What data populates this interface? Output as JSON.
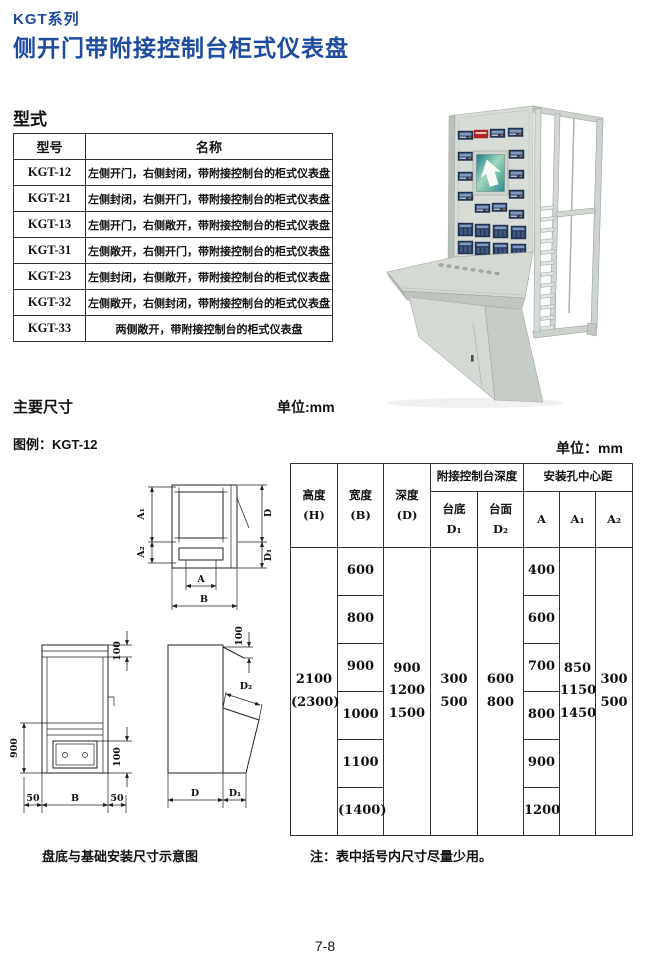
{
  "colors": {
    "title_blue": "#1c4ba0",
    "line_black": "#222222",
    "photo_panel_gray": "#d8dcd6",
    "photo_instrument_navy": "#24375a",
    "photo_nameplate_red": "#b32423",
    "photo_screen_teal": "#2c8b93"
  },
  "header": {
    "series": "KGT系列",
    "title": "侧开门带附接控制台柜式仪表盘"
  },
  "sections": {
    "type_label": "型式",
    "dims_label": "主要尺寸",
    "unit_label_1": "单位:mm",
    "legend_label": "图例：KGT-12",
    "unit_label_2": "单位：mm",
    "caption": "盘底与基础安装尺寸示意图",
    "note": "注：表中括号内尺寸尽量少用。",
    "page_number": "7-8"
  },
  "type_table": {
    "headers": [
      "型号",
      "名称"
    ],
    "rows": [
      {
        "model": "KGT-12",
        "name": "左侧开门，右侧封闭，带附接控制台的柜式仪表盘"
      },
      {
        "model": "KGT-21",
        "name": "左侧封闭，右侧开门，带附接控制台的柜式仪表盘"
      },
      {
        "model": "KGT-13",
        "name": "左侧开门，右侧敞开，带附接控制台的柜式仪表盘"
      },
      {
        "model": "KGT-31",
        "name": "左侧敞开，右侧开门，带附接控制台的柜式仪表盘"
      },
      {
        "model": "KGT-23",
        "name": "左侧封闭，右侧敞开，带附接控制台的柜式仪表盘"
      },
      {
        "model": "KGT-32",
        "name": "左侧敞开，右侧封闭，带附接控制台的柜式仪表盘"
      },
      {
        "model": "KGT-33",
        "name": "两侧敞开，带附接控制台的柜式仪表盘"
      }
    ]
  },
  "dim_table": {
    "headers": {
      "height": "高度",
      "height_sym": "(H)",
      "width": "宽度",
      "width_sym": "(B)",
      "depth": "深度",
      "depth_sym": "(D)",
      "console_group": "附接控制台深度",
      "mount_group": "安装孔中心距",
      "console_bottom": "台底",
      "console_bottom_sym": "D₁",
      "console_top": "台面",
      "console_top_sym": "D₂",
      "a": "A",
      "a1": "A₁",
      "a2": "A₂"
    },
    "height_values": [
      "2100",
      "(2300)"
    ],
    "width_values": [
      "600",
      "800",
      "900",
      "1000",
      "1100",
      "(1400)"
    ],
    "depth_values": [
      "900",
      "1200",
      "1500"
    ],
    "d1_values": [
      "300",
      "500"
    ],
    "d2_values": [
      "600",
      "800"
    ],
    "a_values": [
      "400",
      "600",
      "700",
      "800",
      "900",
      "1200"
    ],
    "a1_values": [
      "850",
      "1150",
      "1450"
    ],
    "a2_values": [
      "300",
      "500"
    ]
  },
  "plan_view": {
    "a1": "A₁",
    "a2": "A₂",
    "d": "D",
    "d1": "D₁",
    "a": "A",
    "b": "B"
  },
  "front_view": {
    "height": "900",
    "top": "100",
    "bottom": "100",
    "left": "50",
    "width": "B",
    "right": "50"
  },
  "side_view": {
    "top": "100",
    "d2": "D₂",
    "d": "D",
    "d1": "D₁"
  }
}
